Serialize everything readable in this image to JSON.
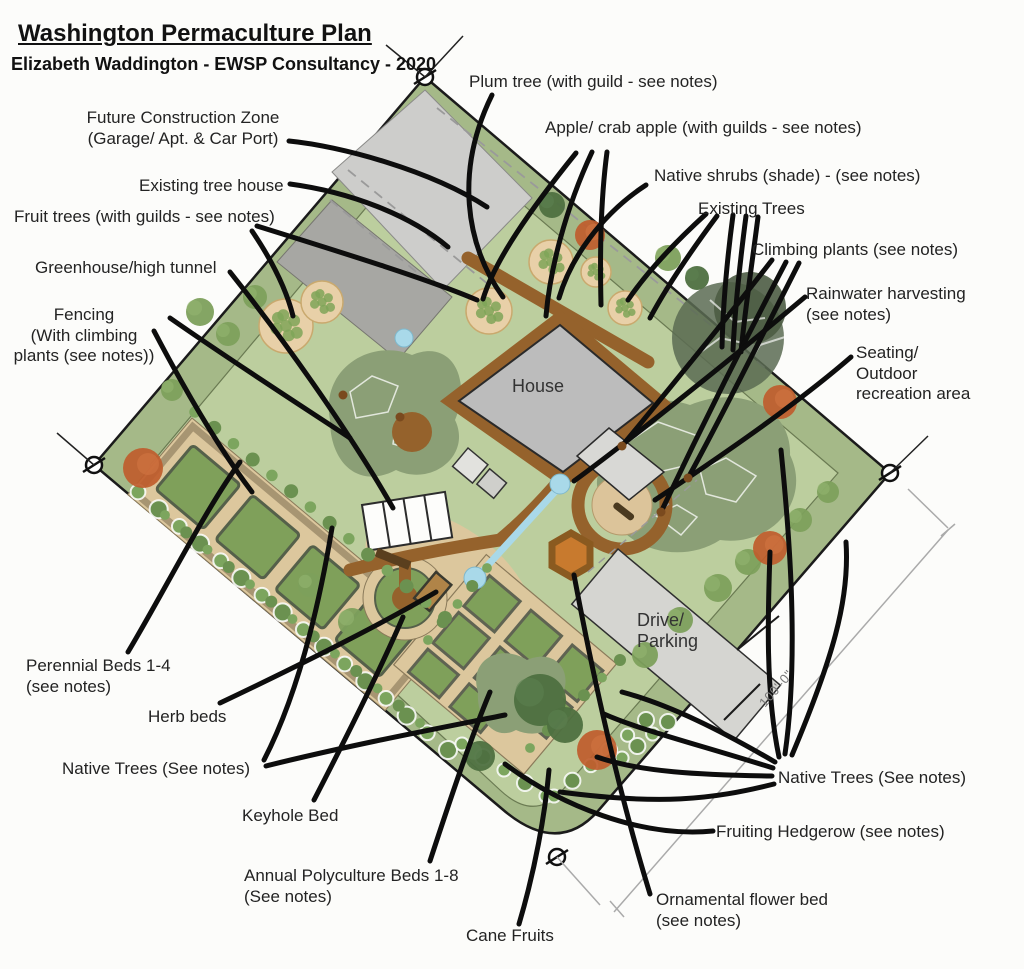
{
  "header": {
    "title": "Washington Permaculture Plan",
    "subtitle": "Elizabeth Waddington - EWSP Consultancy - 2020"
  },
  "plan": {
    "house_label": "House",
    "drive_label": "Drive/\nParking",
    "dimension_label": "100'-0\""
  },
  "labels": {
    "future_construction": "Future Construction Zone\n(Garage/ Apt. & Car Port)",
    "existing_tree_house": "Existing tree house",
    "fruit_trees": "Fruit trees (with guilds - see notes)",
    "greenhouse": "Greenhouse/high tunnel",
    "fencing": "Fencing\n(With climbing\nplants (see notes))",
    "plum_tree": "Plum tree (with guild - see notes)",
    "apple": "Apple/ crab apple (with guilds - see notes)",
    "native_shrubs": "Native shrubs (shade) - (see notes)",
    "existing_trees": "Existing Trees",
    "climbing_plants": "Climbing plants (see notes)",
    "rainwater": "Rainwater harvesting\n(see notes)",
    "seating": "Seating/\nOutdoor\nrecreation area",
    "perennial_beds": "Perennial Beds 1-4\n(see notes)",
    "herb_beds": "Herb beds",
    "native_trees_left": "Native Trees (See notes)",
    "keyhole_bed": "Keyhole Bed",
    "annual_beds": "Annual Polyculture Beds 1-8\n(See notes)",
    "cane_fruits": "Cane Fruits",
    "native_trees_right": "Native Trees (See notes)",
    "fruiting_hedgerow": "Fruiting Hedgerow (see notes)",
    "ornamental_bed": "Ornamental flower bed\n(see notes)"
  },
  "colors": {
    "border_strip_green": "#a5b988",
    "garden_green": "#bcce9e",
    "groundcover_sage": "#8b9f76",
    "bed_green": "#7fa05a",
    "bed_tan": "#dcc79d",
    "path_brown": "#95622c",
    "fruit_tree_tan": "#e8d0a8",
    "native_tree_orange": "#bf5c2c",
    "water_blue": "#a9d9e9",
    "building_gray": "#bcbcbc",
    "annotation_black": "#0d0d0d"
  }
}
